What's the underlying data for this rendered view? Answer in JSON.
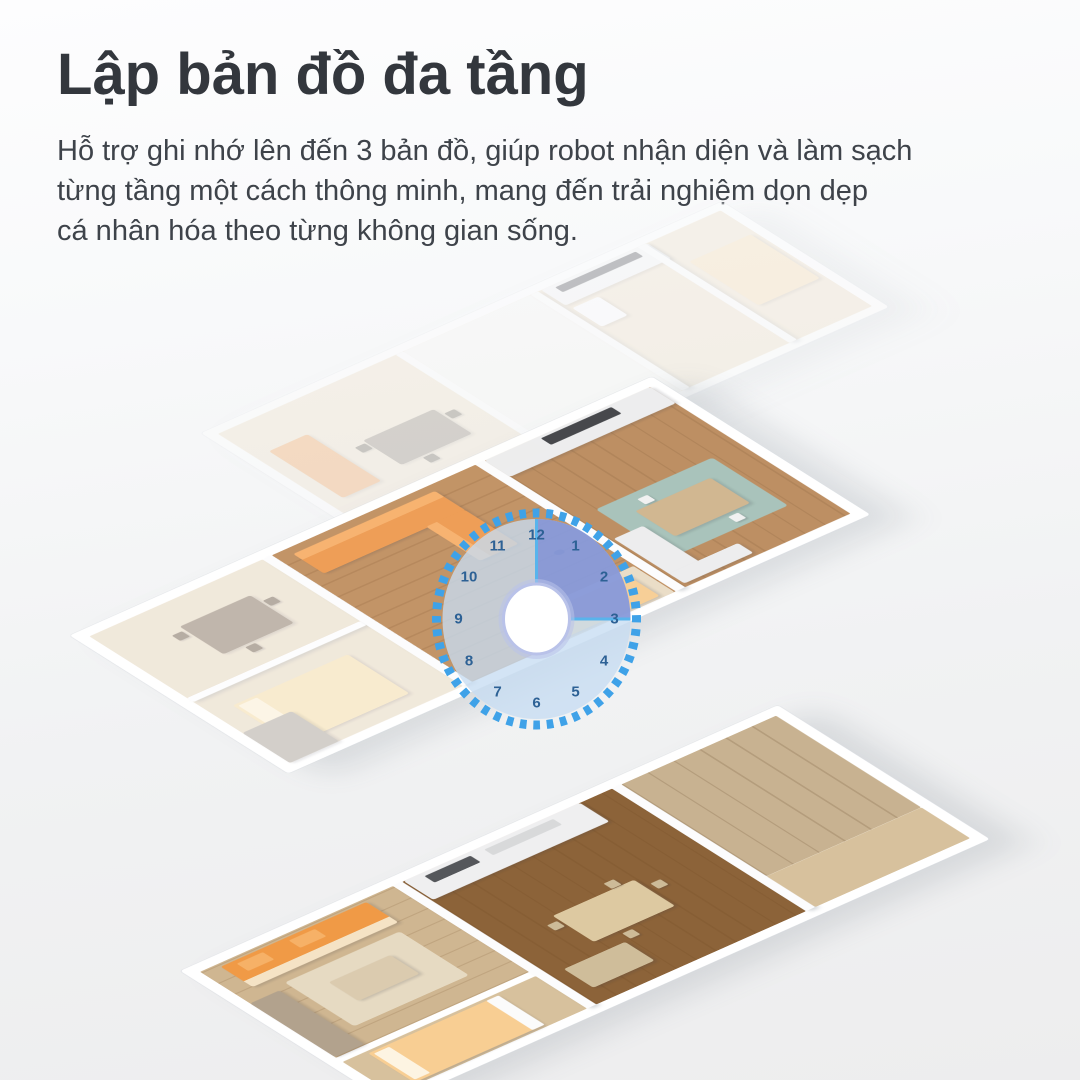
{
  "header": {
    "title": "Lập bản đồ đa tầng",
    "description_lines": [
      "Hỗ trợ ghi nhớ lên đến 3 bản đồ, giúp robot nhận diện và làm sạch",
      "từng tầng một cách thông minh, mang đến trải nghiệm dọn dẹp",
      "cá nhân hóa theo từng không gian sống."
    ]
  },
  "clock": {
    "numbers": [
      "12",
      "1",
      "2",
      "3",
      "4",
      "5",
      "6",
      "7",
      "8",
      "9",
      "10",
      "11"
    ],
    "highlighted_range": "12-3"
  },
  "colors": {
    "title_text": "#33373d",
    "body_text": "#3e434a",
    "accent_blue": "#3fa2e8",
    "dial_fill": "#c6ddf2",
    "sector_fill": "#7e8fd6",
    "sector_edge": "#58b4ec",
    "clock_number": "#2d6195",
    "furniture_orange": "#ef9a4e",
    "bed_peach": "#f8ce93",
    "wood_light": "#cfb691",
    "wood_medium": "#ba8a5c",
    "wood_dark": "#8c6339",
    "rug_teal": "#a5c1b8",
    "background_top": "#fdfdfe",
    "background_bottom": "#ededee"
  }
}
